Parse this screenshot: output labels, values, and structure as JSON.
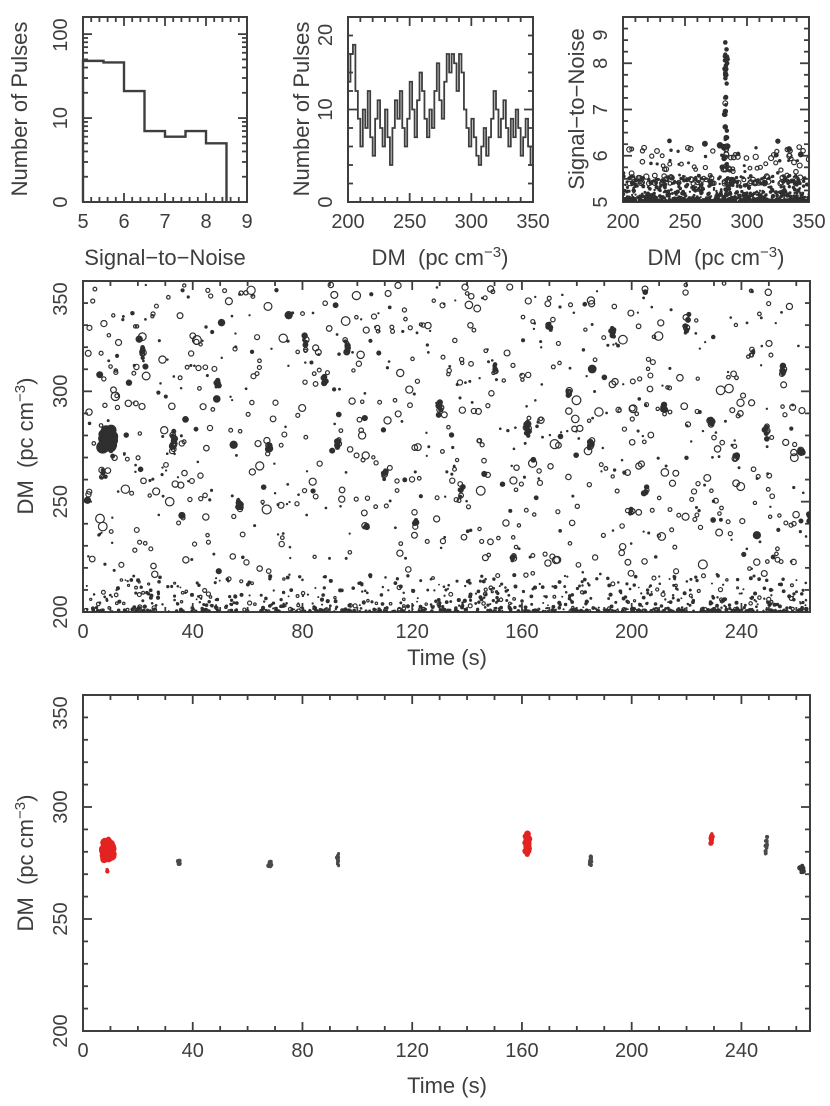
{
  "colors": {
    "background": "#ffffff",
    "ink": "#3e3e3e",
    "point": "#2f2f2f",
    "highlight": "#e32222",
    "muted_point": "#4a4a4a",
    "dark_point": "#383838"
  },
  "labels": {
    "snr_axis": "Signal−to−Noise",
    "pulses_axis": "Number of Pulses",
    "dm_axis_pre": "DM  (pc cm",
    "dm_axis_sup": "−3",
    "dm_axis_post": ")",
    "time_axis": "Time (s)"
  },
  "chart_data": [
    {
      "id": "snr_hist",
      "type": "bar",
      "xlabel": "Signal−to−Noise",
      "ylabel": "Number of Pulses",
      "xlim": [
        5,
        9
      ],
      "ylim": [
        1,
        160
      ],
      "ylog": true,
      "xticks": [
        5,
        6,
        7,
        8,
        9
      ],
      "xminor": 0.2,
      "yticks": [
        {
          "v": 1,
          "l": "0"
        },
        {
          "v": 10,
          "l": "10"
        },
        {
          "v": 100,
          "l": "100"
        }
      ],
      "yminor": "log",
      "bin_edges": [
        5.0,
        5.5,
        6.0,
        6.5,
        7.0,
        7.5,
        8.0,
        8.5
      ],
      "counts": [
        48,
        46,
        21,
        7,
        6,
        7,
        5
      ],
      "rect": [
        83,
        17,
        247,
        202
      ]
    },
    {
      "id": "dm_hist",
      "type": "bar",
      "xlabel": "DM  (pc cm−3)",
      "ylabel": "Number of Pulses",
      "xlim": [
        200,
        350
      ],
      "ylim": [
        0,
        20
      ],
      "xticks": [
        200,
        250,
        300,
        350
      ],
      "xminor": 10,
      "yticks": [
        0,
        10,
        20
      ],
      "yminor": 2,
      "bin_start": 200,
      "bin_width": 2,
      "counts": [
        13,
        16,
        17,
        12,
        9,
        6,
        10,
        8,
        12,
        7,
        5,
        9,
        11,
        8,
        6,
        10,
        7,
        4,
        8,
        11,
        9,
        12,
        8,
        6,
        9,
        13,
        10,
        7,
        11,
        14,
        12,
        9,
        7,
        10,
        8,
        12,
        15,
        11,
        9,
        13,
        16,
        14,
        16,
        15,
        12,
        16,
        14,
        10,
        8,
        6,
        9,
        7,
        5,
        4,
        6,
        8,
        5,
        7,
        9,
        12,
        10,
        7,
        9,
        11,
        8,
        6,
        9,
        7,
        10,
        8,
        5,
        7,
        9,
        6,
        4
      ],
      "rect": [
        348,
        17,
        533,
        202
      ]
    },
    {
      "id": "dm_snr",
      "type": "scatter",
      "xlabel": "DM  (pc cm−3)",
      "ylabel": "Signal−to−Noise",
      "xlim": [
        200,
        350
      ],
      "ylim": [
        5,
        9
      ],
      "xticks": [
        200,
        250,
        300,
        350
      ],
      "xminor": 10,
      "yticks": [
        5,
        6,
        7,
        8,
        9
      ],
      "yminor": 0.25,
      "rect": [
        623,
        17,
        809,
        202
      ],
      "gen": {
        "seed": 11,
        "band": {
          "n": 720,
          "base": 5.02,
          "spread": 0.55,
          "exp": 3.0
        },
        "mid": {
          "n": 150,
          "base": 5.4,
          "spread": 0.8,
          "exp": 2.2
        },
        "outliers": {
          "n": 16,
          "snr_min": 5.9,
          "snr_max": 6.35
        },
        "spike": {
          "dm": 283,
          "dm_spread": 1.6,
          "n": 42,
          "snr_min": 5.7,
          "snr_max": 8.45,
          "exp": 1.6
        },
        "top_points": [
          [
            282.5,
            8.45
          ],
          [
            283.5,
            8.3
          ],
          [
            282.2,
            8.15
          ],
          [
            284.0,
            8.0
          ],
          [
            283.0,
            7.95
          ],
          [
            282.6,
            7.8
          ]
        ]
      }
    },
    {
      "id": "time_dm_all",
      "type": "scatter",
      "xlabel": "Time (s)",
      "ylabel": "DM  (pc cm−3)",
      "xlim": [
        0,
        265
      ],
      "ylim": [
        200,
        350
      ],
      "xticks": [
        0,
        40,
        80,
        120,
        160,
        200,
        240
      ],
      "xminor": 10,
      "yticks": [
        200,
        250,
        300,
        350
      ],
      "yminor": 10,
      "rect": [
        83,
        281,
        810,
        612
      ],
      "gen": {
        "seed": 5,
        "background": {
          "n": 820,
          "dm_min": 216,
          "dm_max": 349
        },
        "bottom_band": {
          "n": 820,
          "dm_min": 200.4,
          "dm_span": 16,
          "exp": 2.4
        },
        "big_blob": {
          "t": 9,
          "dm": 279,
          "n": 85,
          "dt": 2.3,
          "ddm": 5.0
        },
        "streaks": [
          [
            7,
            262,
            6,
            4
          ],
          [
            22,
            318,
            8,
            6
          ],
          [
            33,
            278,
            14,
            9
          ],
          [
            49,
            304,
            7,
            5
          ],
          [
            57,
            250,
            8,
            6
          ],
          [
            68,
            274,
            9,
            3
          ],
          [
            81,
            322,
            10,
            7
          ],
          [
            88,
            306,
            8,
            5
          ],
          [
            93,
            277,
            10,
            5
          ],
          [
            96,
            320,
            9,
            8
          ],
          [
            103,
            238,
            6,
            4
          ],
          [
            110,
            262,
            8,
            5
          ],
          [
            121,
            240,
            7,
            4
          ],
          [
            130,
            292,
            9,
            6
          ],
          [
            138,
            255,
            8,
            7
          ],
          [
            150,
            310,
            7,
            4
          ],
          [
            157,
            225,
            6,
            4
          ],
          [
            162,
            283,
            16,
            7
          ],
          [
            170,
            330,
            8,
            5
          ],
          [
            177,
            300,
            7,
            4
          ],
          [
            185,
            276,
            10,
            4
          ],
          [
            193,
            327,
            9,
            7
          ],
          [
            200,
            246,
            6,
            4
          ],
          [
            205,
            255,
            7,
            4
          ],
          [
            212,
            292,
            8,
            5
          ],
          [
            220,
            330,
            9,
            7
          ],
          [
            229,
            286,
            10,
            4
          ],
          [
            238,
            270,
            7,
            4
          ],
          [
            244,
            318,
            6,
            4
          ],
          [
            249,
            282,
            11,
            7
          ],
          [
            255,
            310,
            9,
            7
          ],
          [
            262,
            273,
            10,
            3
          ],
          [
            265,
            243,
            8,
            5
          ]
        ]
      }
    },
    {
      "id": "time_dm_cand",
      "type": "scatter",
      "xlabel": "Time (s)",
      "ylabel": "DM  (pc cm−3)",
      "xlim": [
        0,
        265
      ],
      "ylim": [
        200,
        350
      ],
      "xticks": [
        0,
        40,
        80,
        120,
        160,
        200,
        240
      ],
      "xminor": 10,
      "yticks": [
        200,
        250,
        300,
        350
      ],
      "yminor": 10,
      "rect": [
        83,
        695,
        810,
        1031
      ],
      "seed": 3,
      "groups": [
        {
          "t": 9,
          "dm": 281.0,
          "n": 90,
          "dt": 2.0,
          "ddm": 4.8,
          "rmin": 1.5,
          "rmax": 5.5,
          "color": "highlight"
        },
        {
          "t": 9,
          "dm": 271.5,
          "n": 5,
          "dt": 0.4,
          "ddm": 1.5,
          "rmin": 1.2,
          "rmax": 2.2,
          "color": "highlight"
        },
        {
          "t": 35,
          "dm": 275.5,
          "n": 10,
          "dt": 0.5,
          "ddm": 1.8,
          "rmin": 1.2,
          "rmax": 2.4,
          "color": "muted"
        },
        {
          "t": 68,
          "dm": 274.0,
          "n": 12,
          "dt": 0.7,
          "ddm": 1.6,
          "rmin": 1.3,
          "rmax": 2.6,
          "color": "muted"
        },
        {
          "t": 93,
          "dm": 276.5,
          "n": 14,
          "dt": 0.45,
          "ddm": 3.4,
          "rmin": 1.2,
          "rmax": 2.4,
          "color": "muted"
        },
        {
          "t": 162,
          "dm": 283.5,
          "n": 42,
          "dt": 0.8,
          "ddm": 5.6,
          "rmin": 1.4,
          "rmax": 3.6,
          "color": "highlight"
        },
        {
          "t": 185,
          "dm": 276.0,
          "n": 13,
          "dt": 0.45,
          "ddm": 3.0,
          "rmin": 1.2,
          "rmax": 2.3,
          "color": "muted"
        },
        {
          "t": 229,
          "dm": 285.5,
          "n": 18,
          "dt": 0.5,
          "ddm": 3.0,
          "rmin": 1.3,
          "rmax": 2.6,
          "color": "highlight"
        },
        {
          "t": 249,
          "dm": 282.0,
          "n": 15,
          "dt": 0.45,
          "ddm": 4.8,
          "rmin": 1.2,
          "rmax": 2.2,
          "color": "muted"
        },
        {
          "t": 262,
          "dm": 272.5,
          "n": 18,
          "dt": 0.9,
          "ddm": 2.0,
          "rmin": 1.5,
          "rmax": 3.0,
          "color": "dark"
        }
      ]
    }
  ]
}
